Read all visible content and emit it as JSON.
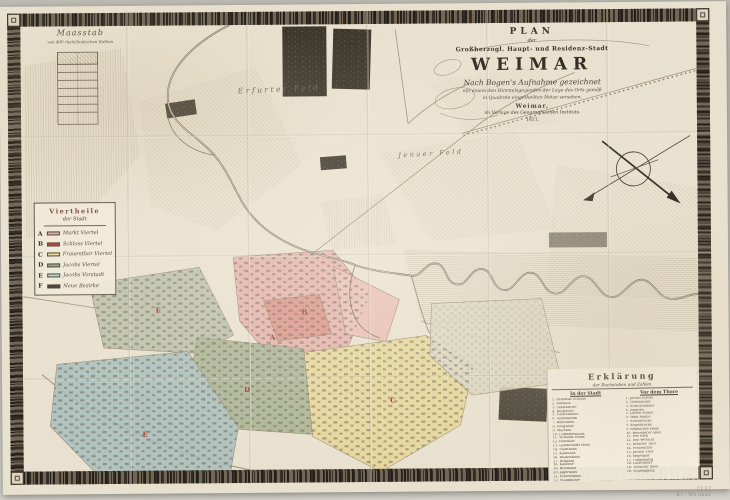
{
  "title_block": {
    "plan": "PLAN",
    "der": "der",
    "subtitle": "Großherzogl. Haupt- und Residenz-Stadt",
    "main": "WEIMAR",
    "script": "Nach Bogen's Aufnahme gezeichnet",
    "small1": "mit einem den Himmelsgegenden der Lage des Orts gemäß",
    "small2": "in Quadrate eingetheilten Netze versehen.",
    "city": "Weimar,",
    "publisher": "im Verlage des Geographischen Instituts.",
    "year": "1821."
  },
  "scalebar": {
    "title": "Maasstab",
    "subtitle": "von 400 rheinländischen Ruthen"
  },
  "legend": {
    "title_line1": "Viertheile",
    "title_line2": "der Stadt",
    "items": [
      {
        "letter": "A",
        "color": "#e2a49e",
        "label": "Markt Viertel"
      },
      {
        "letter": "B",
        "color": "#b5443a",
        "label": "Schloss Viertel"
      },
      {
        "letter": "C",
        "color": "#e4d494",
        "label": "Frauenthor Viertel"
      },
      {
        "letter": "D",
        "color": "#8fa184",
        "label": "Jacobs Viertel"
      },
      {
        "letter": "E",
        "color": "#b7d2d4",
        "label": "Jacobs Vorstadt"
      },
      {
        "letter": "F",
        "color": "#433d33",
        "label": "Neue Bezirke"
      }
    ]
  },
  "fields": [
    {
      "label": "Erfurter Feld"
    },
    {
      "label": "Jenaer Feld"
    }
  ],
  "districts": [
    {
      "letter": "A",
      "x": 268,
      "y": 328
    },
    {
      "letter": "B",
      "x": 300,
      "y": 303
    },
    {
      "letter": "C",
      "x": 388,
      "y": 392
    },
    {
      "letter": "D",
      "x": 242,
      "y": 380
    },
    {
      "letter": "E",
      "x": 140,
      "y": 424
    },
    {
      "letter": "F",
      "x": 154,
      "y": 300
    }
  ],
  "index": {
    "title": "Erklärung",
    "subtitle": "der Buchstaben und Zahlen",
    "columns": [
      {
        "header": "In der Stadt",
        "entries": [
          "1. Residenz Schloss",
          "2. Rathaus",
          "3. Stadtkirche",
          "4. Hofkirche",
          "5. Fürstenhaus",
          "6. Gymnasium",
          "7. Bibliothek",
          "8. Zeughaus",
          "9. Marstall",
          "10. Comödienhaus",
          "11. Wittums Palais",
          "12. Posthaus",
          "13. Landschafts Haus",
          "14. Stadthaus",
          "15. Kaufhaus",
          "16. Waisenhaus",
          "17. Hospital",
          "18. Kaserne",
          "19. Brauhaus",
          "20. Jägerhaus",
          "21. Schiesshaus",
          "22. Stadtmühle",
          "23. Armenhaus",
          "24. Garnison Kirche"
        ]
      },
      {
        "header": "Vor dem Thore",
        "entries": [
          "1. Jacobs Kirche",
          "2. Gottesacker",
          "3. Schützenhaus",
          "4. Ziegelei",
          "5. Lotten Mühle",
          "6. Walk Mühle",
          "7. Sternbrücke",
          "8. Kegelbrücke",
          "9. Römisches Haus",
          "10. Belvederer Allee",
          "11. Der Park",
          "12. Das Webicht",
          "13. Erfurter Thor",
          "14. Frauenthor",
          "15. Jacobs Thor",
          "16. Kegelthor",
          "17. Galgenberg",
          "18. Lützendorf",
          "19. Tiefurter Allee",
          "20. Schiessplatz"
        ]
      }
    ]
  },
  "stamp": {
    "line1": "2137",
    "line2": "Kt. Weimar"
  },
  "palette": {
    "paper": "#e9e1cf",
    "border_ink": "#241f18",
    "background": "#c8c5bf",
    "river_ink": "#6f6757",
    "letter_red": "#a03428"
  }
}
